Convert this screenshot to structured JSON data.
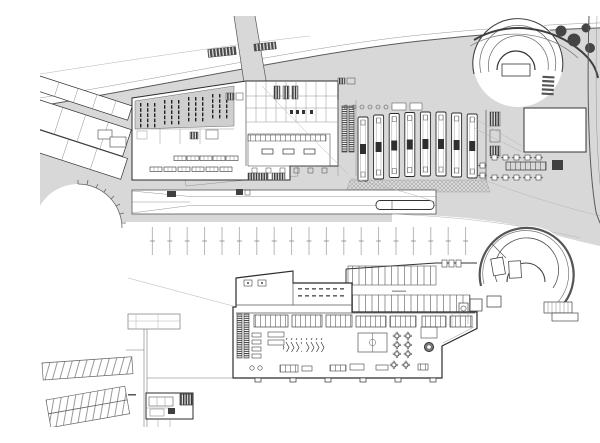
{
  "document": {
    "type": "architectural-drawing",
    "title": "Bus terminal complex — ground level site plan (top) and lower level plan (bottom)",
    "visible_text": "none",
    "style": "black and white technical linework on white sheet"
  },
  "colors": {
    "background": "#ffffff",
    "paving": "#d8d8d8",
    "hall_fill": "#cfcfcf",
    "line_dark": "#2b2b2b",
    "line_medium": "#555555",
    "line_light": "#b5b5b5",
    "fill_dark": "#3f3f3f",
    "tree": "#454545"
  },
  "site_plan": {
    "label": "Ground level site plan",
    "position": "top half of sheet",
    "bus_platforms": 8,
    "platform_bollards": 8,
    "trees": 4,
    "pedestrian_crossings": 3,
    "left_parcel_rows": 3,
    "east_buildings": 3,
    "market_shelf_clusters": 4,
    "restaurant_tables": 12,
    "escalator_runs": 2,
    "articulated_bus": 1,
    "spiral_ramp": 1,
    "kerb_curve_ticks": 8
  },
  "column_grid": {
    "label": "Structural column grid ticks between plans",
    "tick_count": 19
  },
  "lower_plan": {
    "label": "Lower level floor plan",
    "position": "bottom half of sheet",
    "parking_rows": 2,
    "angled_parking_bands": 2,
    "spiral_ramp_cars": 4,
    "kiosk_units": 7,
    "escalator_runs": 2,
    "sports_court": 1,
    "cafe_tables": 8,
    "bike_rack_groups": 2,
    "round_pool": 1,
    "technical_room": 1
  }
}
